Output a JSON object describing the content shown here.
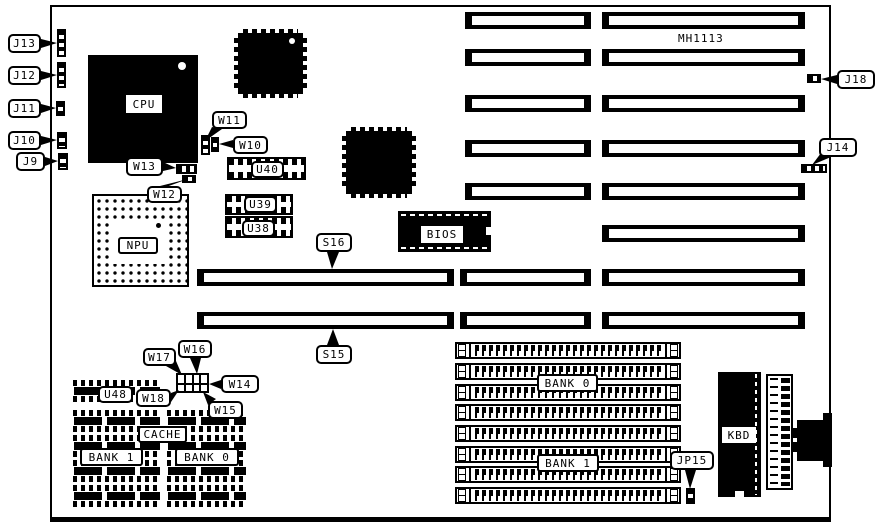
{
  "board": {
    "model": "MH1113"
  },
  "callouts": {
    "j13": "J13",
    "j12": "J12",
    "j11": "J11",
    "j10": "J10",
    "j9": "J9",
    "j18": "J18",
    "j14": "J14",
    "jp15": "JP15",
    "w10": "W10",
    "w11": "W11",
    "w12": "W12",
    "w13": "W13",
    "w14": "W14",
    "w15": "W15",
    "w16": "W16",
    "w17": "W17",
    "w18": "W18",
    "s15": "S15",
    "s16": "S16",
    "u38": "U38",
    "u39": "U39",
    "u40": "U40",
    "u48": "U48"
  },
  "components": {
    "cpu": "CPU",
    "npu": "NPU",
    "bios": "BIOS",
    "kbd": "KBD",
    "cache": "CACHE",
    "cache_bank_1": "BANK 1",
    "cache_bank_0": "BANK 0",
    "simm_bank_0": "BANK 0",
    "simm_bank_1": "BANK 1"
  }
}
